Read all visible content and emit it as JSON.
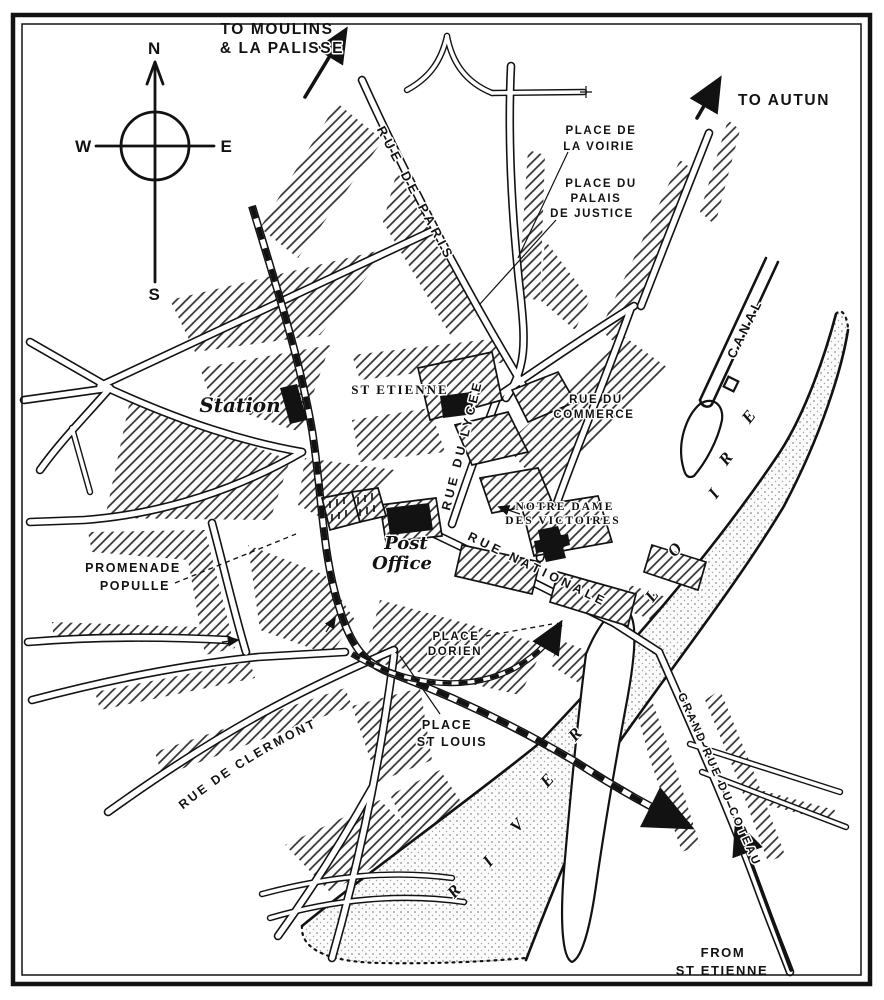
{
  "map": {
    "compass": {
      "north": "N",
      "south": "S",
      "east": "E",
      "west": "W"
    },
    "route_labels": {
      "to_moulins_line1": "TO MOULINS",
      "to_moulins_line2": "& LA PALISSE",
      "to_autun": "TO AUTUN",
      "from_st_etienne_line1": "FROM",
      "from_st_etienne_line2": "ST ETIENNE"
    },
    "streets": {
      "rue_de_paris": "RUE DE PARIS",
      "rue_du_lycee": "RUE DU LYCEE",
      "rue_du_commerce_line1": "RUE DU",
      "rue_du_commerce_line2": "COMMERCE",
      "rue_nationale": "RUE NATIONALE",
      "grand_rue_du_coteau": "GRAND RUE DU COTEAU",
      "rue_de_clermont": "RUE DE CLERMONT",
      "promenade_line1": "PROMENADE",
      "promenade_line2": "POPULLE"
    },
    "places": {
      "place_de_la_voirie_line1": "PLACE DE",
      "place_de_la_voirie_line2": "LA VOIRIE",
      "place_du_palais_line1": "PLACE DU",
      "place_du_palais_line2": "PALAIS",
      "place_du_palais_line3": "DE JUSTICE",
      "place_dorien_line1": "PLACE",
      "place_dorien_line2": "DORIEN",
      "place_st_louis_line1": "PLACE",
      "place_st_louis_line2": "ST LOUIS"
    },
    "landmarks": {
      "station": "Station",
      "post_office_line1": "Post",
      "post_office_line2": "Office",
      "st_etienne": "ST ETIENNE",
      "notre_dame_line1": "NOTRE DAME",
      "notre_dame_line2": "DES VICTOIRES"
    },
    "water": {
      "canal": "CANAL",
      "loire_letters": [
        "L",
        "O",
        "I",
        "R",
        "E"
      ],
      "river_letters": [
        "R",
        "I",
        "V",
        "E",
        "R"
      ]
    },
    "colors": {
      "ink": "#121212",
      "paper": "#ffffff"
    }
  }
}
